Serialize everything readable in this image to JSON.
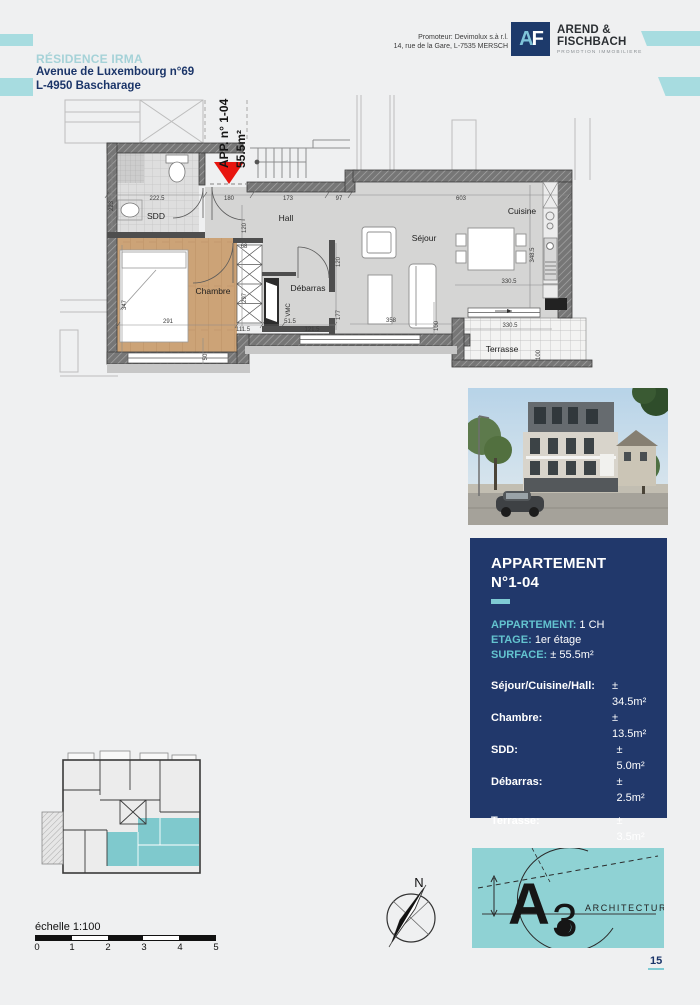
{
  "header": {
    "residence": "RÉSIDENCE IRMA",
    "address1": "Avenue de Luxembourg n°69",
    "address2": "L-4950 Bascharage",
    "promoter_line1": "Promoteur: Devimolux s.à r.l.",
    "promoter_line2": "14, rue de la Gare, L-7535 MERSCH",
    "logo": {
      "a": "A",
      "f": "F",
      "name1": "AREND &",
      "name2": "FISCHBACH",
      "tagline": "PROMOTION IMMOBILIERE"
    }
  },
  "plan": {
    "tag_line": "APP. n° 1-04",
    "tag_area": "55.5m²",
    "rooms": {
      "sdd": "SDD",
      "hall": "Hall",
      "sejour": "Séjour",
      "cuisine": "Cuisine",
      "chambre": "Chambre",
      "debarras": "Débarras",
      "vmc": "VMC",
      "terrasse": "Terrasse"
    },
    "dims": [
      "223",
      "222.5",
      "180",
      "173",
      "97",
      "603",
      "348.5",
      "120",
      "68",
      "297",
      "347",
      "291",
      "111.5",
      "50",
      "51.5",
      "121.5",
      "120",
      "177",
      "358",
      "100",
      "330.5",
      "330.5",
      "100"
    ]
  },
  "panel": {
    "title1": "APPARTEMENT",
    "title2": "N°1-04",
    "fields": [
      {
        "label": "APPARTEMENT:",
        "value": "1 CH"
      },
      {
        "label": "ETAGE:",
        "value": "1er étage"
      },
      {
        "label": "SURFACE:",
        "value": "± 55.5m²"
      }
    ],
    "areas": [
      {
        "label": "Séjour/Cuisine/Hall:",
        "value": "± 34.5m²"
      },
      {
        "label": "Chambre:",
        "value": "± 13.5m²"
      },
      {
        "label": "SDD:",
        "value": "± 5.0m²"
      },
      {
        "label": "Débarras:",
        "value": "± 2.5m²"
      }
    ],
    "terrace": {
      "label": "Terrasse:",
      "value": "± 3.5m²"
    }
  },
  "footer": {
    "scale_label": "échelle 1:100",
    "scale_ticks": [
      "0",
      "1",
      "2",
      "3",
      "4",
      "5"
    ],
    "compass_n": "N",
    "a3_letter": "A",
    "a3_three": "3",
    "a3_text": "ARCHITECTURE",
    "page_number": "15"
  },
  "colors": {
    "accent_teal": "#8FD2D4",
    "navy": "#21386B",
    "arrow_red": "#E8150F",
    "wood": "#CCA377",
    "floor_gray": "#D5D5D4"
  }
}
